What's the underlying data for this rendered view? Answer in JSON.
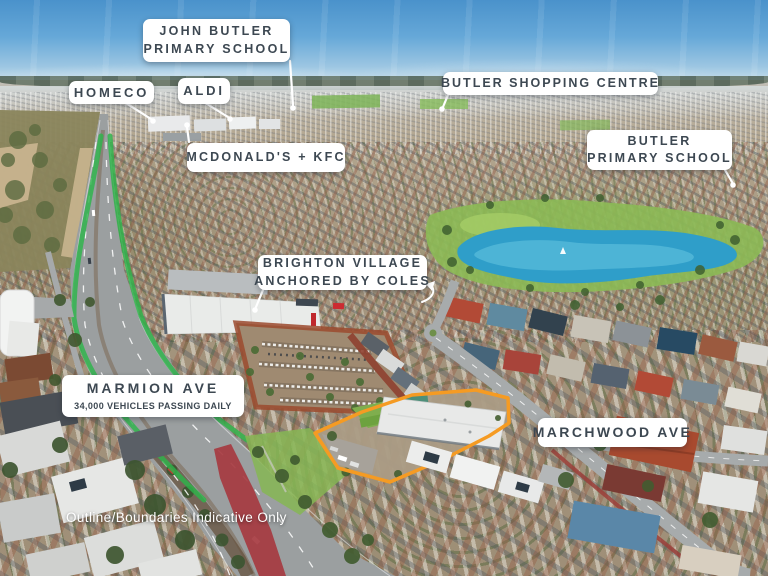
{
  "colors": {
    "accent_orange": "#F59B23",
    "highlight_green": "#2DB44A",
    "label_text": "#3D4852",
    "label_bg": "#FFFFFF"
  },
  "callouts": [
    {
      "id": "john-butler-primary-school",
      "lines": [
        "JOHN BUTLER",
        "PRIMARY SCHOOL"
      ]
    },
    {
      "id": "homeco",
      "lines": [
        "HOMECO"
      ]
    },
    {
      "id": "aldi",
      "lines": [
        "ALDI"
      ]
    },
    {
      "id": "mcdonalds-kfc",
      "lines": [
        "MCDONALD'S + KFC"
      ]
    },
    {
      "id": "butler-shopping-centre",
      "lines": [
        "BUTLER SHOPPING CENTRE"
      ]
    },
    {
      "id": "butler-primary-school",
      "lines": [
        "BUTLER",
        "PRIMARY SCHOOL"
      ]
    },
    {
      "id": "brighton-village",
      "lines": [
        "BRIGHTON VILLAGE",
        "ANCHORED BY COLES"
      ]
    },
    {
      "id": "marmion-ave",
      "lines": [
        "MARMION AVE",
        "34,000 VEHICLES PASSING DAILY"
      ]
    },
    {
      "id": "marchwood-ave",
      "lines": [
        "MARCHWOOD AVE"
      ]
    }
  ],
  "footnote": "Outline/Boundaries Indicative Only"
}
